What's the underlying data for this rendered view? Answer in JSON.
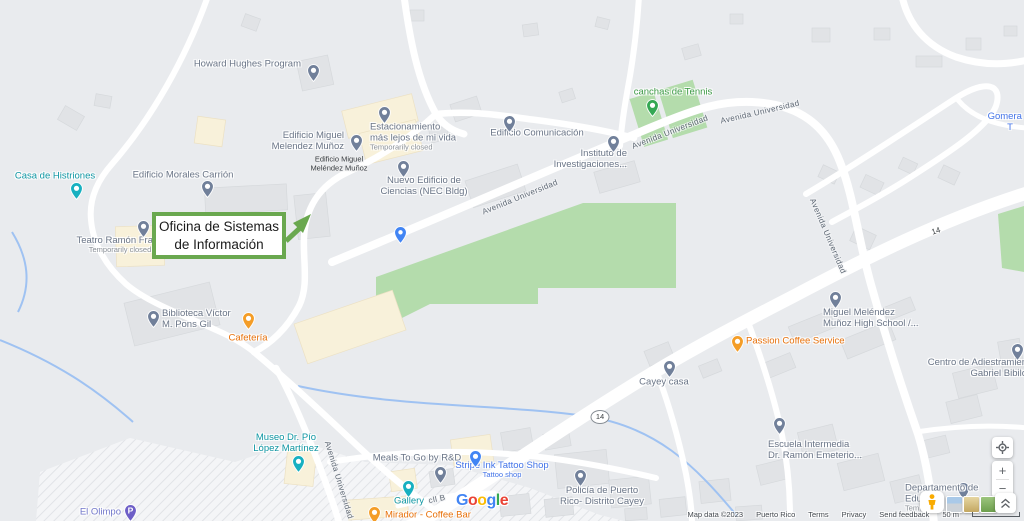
{
  "annotation": {
    "lines": [
      "Oficina de Sistemas",
      "de Información"
    ],
    "border_color": "#6aa84f"
  },
  "palette": {
    "gray": {
      "text": "#6a7587",
      "pin": "#71809a"
    },
    "teal": {
      "text": "#0e96a3",
      "pin": "#17b0c0"
    },
    "orange": {
      "text": "#e8710a",
      "pin": "#f49d27"
    },
    "green": {
      "text": "#3d9a46",
      "pin": "#34a853"
    },
    "blue": {
      "text": "#4374e9",
      "pin": "#4285f4"
    },
    "purple": {
      "text": "#7277cb",
      "pin": "#6e5fc7"
    }
  },
  "markers": [
    {
      "name": "howard-hughes-program",
      "lines": [
        "Howard Hughes Program"
      ],
      "color": "gray",
      "icon": "school",
      "pin": [
        313,
        70
      ],
      "label": [
        301,
        64,
        "right"
      ]
    },
    {
      "name": "edificio-miguel-melendez-munoz",
      "lines": [
        "Edificio Miguel",
        "Melendez Muñoz"
      ],
      "color": "gray",
      "icon": "school",
      "pin": [
        356,
        140
      ],
      "label": [
        344,
        141,
        "right"
      ]
    },
    {
      "name": "estacionamiento-mas-lejos-de-mi-vida",
      "lines": [
        "Estacionamiento",
        "más lejos de mi vida"
      ],
      "sub": "Temporarily closed",
      "color": "gray",
      "icon": "generic",
      "pin": [
        384,
        112
      ],
      "label": [
        370,
        137,
        "left"
      ]
    },
    {
      "name": "nuevo-edificio-de-ciencias",
      "lines": [
        "Nuevo Edificio de",
        "Ciencias (NEC Bldg)"
      ],
      "color": "gray",
      "icon": "school",
      "pin": [
        403,
        166
      ],
      "label": [
        424,
        186,
        "center"
      ]
    },
    {
      "name": "edificio-comunicacion",
      "lines": [
        "Edificio Comunicación"
      ],
      "color": "gray",
      "icon": "generic",
      "pin": [
        509,
        121
      ],
      "label": [
        537,
        133,
        "center"
      ]
    },
    {
      "name": "canchas-de-tennis",
      "lines": [
        "canchas de Tennis"
      ],
      "color": "green",
      "icon": "park",
      "pin": [
        652,
        105
      ],
      "label": [
        673,
        92,
        "center"
      ]
    },
    {
      "name": "instituto-de-investigaciones",
      "lines": [
        "Instituto de",
        "Investigaciones..."
      ],
      "color": "gray",
      "icon": "generic",
      "pin": [
        613,
        141
      ],
      "label": [
        627,
        159,
        "right"
      ]
    },
    {
      "name": "casa-de-histriones",
      "lines": [
        "Casa de Histriones"
      ],
      "color": "teal",
      "icon": "attraction",
      "pin": [
        76,
        188
      ],
      "label": [
        55,
        176,
        "center"
      ]
    },
    {
      "name": "edificio-morales-carrion",
      "lines": [
        "Edificio Morales Carrión"
      ],
      "color": "gray",
      "icon": "school",
      "pin": [
        207,
        186
      ],
      "label": [
        183,
        175,
        "center"
      ]
    },
    {
      "name": "teatro-ramon-frade",
      "lines": [
        "Teatro Ramón Frade"
      ],
      "sub": "Temporarily closed",
      "color": "gray",
      "icon": "generic",
      "pin": [
        143,
        226
      ],
      "label": [
        120,
        245,
        "center"
      ]
    },
    {
      "name": "campus-blue-place",
      "lines": [],
      "color": "blue",
      "icon": "place",
      "pin": [
        400,
        232
      ],
      "label": null
    },
    {
      "name": "biblioteca-victor-m-pons-gil",
      "lines": [
        "Biblioteca Víctor",
        "M. Pons Gil"
      ],
      "color": "gray",
      "icon": "library",
      "pin": [
        153,
        316
      ],
      "label": [
        162,
        319,
        "left"
      ]
    },
    {
      "name": "cafeteria",
      "lines": [
        "Cafetería"
      ],
      "color": "orange",
      "icon": "restaurant",
      "pin": [
        248,
        318
      ],
      "label": [
        248,
        338,
        "center"
      ]
    },
    {
      "name": "museo-dr-pio-lopez-martinez",
      "lines": [
        "Museo Dr. Pío",
        "López Martínez"
      ],
      "color": "teal",
      "icon": "museum",
      "pin": [
        298,
        461
      ],
      "label": [
        286,
        443,
        "center"
      ]
    },
    {
      "name": "el-olimpo",
      "lines": [
        "El Olimpo"
      ],
      "color": "purple",
      "icon": "parking",
      "pin": [
        130,
        510
      ],
      "label": [
        121,
        512,
        "right"
      ]
    },
    {
      "name": "meals-to-go-by-rd",
      "lines": [
        "Meals To Go by R&D"
      ],
      "color": "gray",
      "icon": "generic",
      "pin": [
        440,
        472
      ],
      "label": [
        417,
        458,
        "center"
      ]
    },
    {
      "name": "stripe-ink-tattoo-shop",
      "lines": [
        "Stripe Ink Tattoo Shop"
      ],
      "sub": "Tattoo shop",
      "sub_colored": true,
      "color": "blue",
      "icon": "store",
      "pin": [
        475,
        456
      ],
      "label": [
        502,
        470,
        "center"
      ]
    },
    {
      "name": "gallery",
      "lines": [
        "Gallery"
      ],
      "color": "teal",
      "icon": "attraction",
      "pin": [
        408,
        486
      ],
      "label": [
        409,
        501,
        "center"
      ]
    },
    {
      "name": "mirador-coffee-bar",
      "lines": [
        "Mirador - Coffee Bar"
      ],
      "color": "orange",
      "icon": "cafe",
      "pin": [
        374,
        512
      ],
      "label": [
        385,
        515,
        "left"
      ]
    },
    {
      "name": "policia-de-puerto-rico-distrito-cayey",
      "lines": [
        "Policía de Puerto",
        "Rico- Distrito Cayey"
      ],
      "color": "gray",
      "icon": "police",
      "pin": [
        580,
        475
      ],
      "label": [
        602,
        496,
        "center"
      ]
    },
    {
      "name": "escuela-intermedia-dr-ramon-emeterio",
      "lines": [
        "Escuela Intermedia",
        "Dr. Ramón Emeterio..."
      ],
      "color": "gray",
      "icon": "school",
      "pin": [
        779,
        423
      ],
      "label": [
        768,
        450,
        "left"
      ]
    },
    {
      "name": "miguel-melendez-munoz-high-school",
      "lines": [
        "Miguel Meléndez",
        "Muñoz High School /..."
      ],
      "color": "gray",
      "icon": "school",
      "pin": [
        835,
        297
      ],
      "label": [
        823,
        318,
        "left"
      ]
    },
    {
      "name": "passion-coffee-service",
      "lines": [
        "Passion Coffee Service"
      ],
      "color": "orange",
      "icon": "cafe",
      "pin": [
        737,
        341
      ],
      "label": [
        746,
        341,
        "left"
      ]
    },
    {
      "name": "cayey-casa",
      "lines": [
        "Cayey casa"
      ],
      "color": "gray",
      "icon": "generic",
      "pin": [
        669,
        366
      ],
      "label": [
        664,
        382,
        "center"
      ]
    },
    {
      "name": "centro-de-adiestramiento-gabriel-bibilo",
      "lines": [
        "Centro de Adiestramien",
        "Gabriel Bibilo"
      ],
      "color": "gray",
      "icon": "school",
      "pin": [
        1017,
        349
      ],
      "label": [
        1027,
        368,
        "right"
      ]
    },
    {
      "name": "gomera",
      "lines": [
        "Gomera M",
        "T"
      ],
      "color": "blue",
      "icon": "store",
      "pin": null,
      "label": [
        1010,
        122,
        "center"
      ]
    },
    {
      "name": "departamento-de-educacion",
      "lines": [
        "Departamento de",
        "Educ..."
      ],
      "sub": "Tem...",
      "color": "gray",
      "icon": "generic",
      "pin": [
        963,
        488
      ],
      "label": [
        905,
        498,
        "left"
      ]
    }
  ],
  "building_labels": [
    {
      "name": "edificio-miguel-melendez-munoz-building",
      "lines": [
        "Edificio Miguel",
        "Meléndez Muñoz"
      ],
      "x": 339,
      "y": 164
    }
  ],
  "road_labels": [
    {
      "text": "Avenida Universidad",
      "x": 520,
      "y": 197,
      "rot": -22
    },
    {
      "text": "Avenida Universidad",
      "x": 670,
      "y": 132,
      "rot": -21
    },
    {
      "text": "Avenida Universidad",
      "x": 760,
      "y": 112,
      "rot": -13
    },
    {
      "text": "Avenida Universidad",
      "x": 828,
      "y": 236,
      "rot": 67
    },
    {
      "text": "Avenida Universidad",
      "x": 339,
      "y": 480,
      "rot": 73
    },
    {
      "text": "cll B",
      "x": 437,
      "y": 499,
      "rot": -12
    }
  ],
  "route_shields": [
    {
      "text": "14",
      "x": 600,
      "y": 417
    }
  ],
  "road_numbers": [
    {
      "text": "14",
      "x": 936,
      "y": 231,
      "rot": -18
    }
  ],
  "google_logo": {
    "letters": [
      {
        "ch": "G",
        "color": "#4285F4"
      },
      {
        "ch": "o",
        "color": "#EA4335"
      },
      {
        "ch": "o",
        "color": "#FBBC05"
      },
      {
        "ch": "g",
        "color": "#4285F4"
      },
      {
        "ch": "l",
        "color": "#34A853"
      },
      {
        "ch": "e",
        "color": "#EA4335"
      }
    ]
  },
  "controls": {
    "zoom_in": "+",
    "zoom_out": "−"
  },
  "attribution": {
    "map_data": "Map data ©2023",
    "region": "Puerto Rico",
    "links": [
      "Terms",
      "Privacy",
      "Send feedback"
    ],
    "scale": "50 m"
  }
}
